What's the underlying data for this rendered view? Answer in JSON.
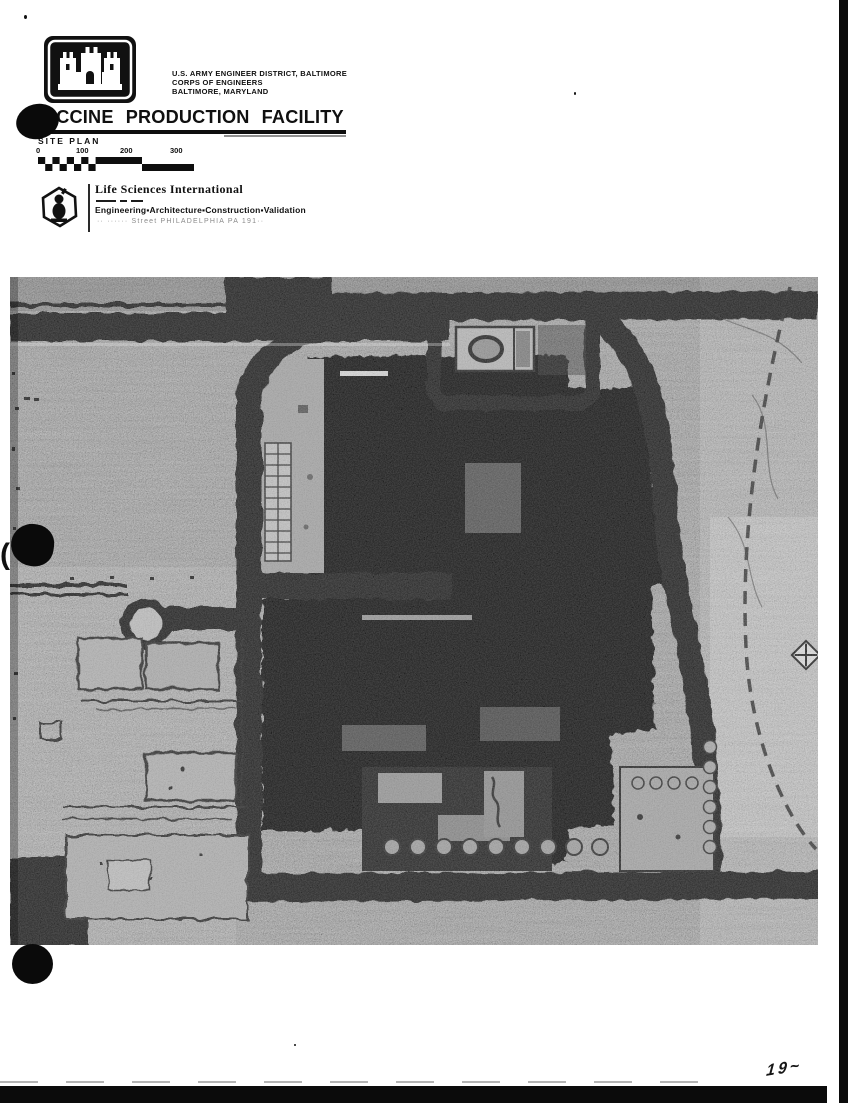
{
  "agency": {
    "line1": "U.S. ARMY ENGINEER DISTRICT, BALTIMORE",
    "line2": "CORPS OF ENGINEERS",
    "line3": "BALTIMORE, MARYLAND"
  },
  "titleblock": {
    "title": "VACCINE PRODUCTION FACILITY",
    "subtitle": "SITE PLAN"
  },
  "scale_bar": {
    "labels": [
      "0",
      "100",
      "200",
      "300"
    ]
  },
  "firm": {
    "name": "Life Sciences International",
    "tagline": "Engineering▪Architecture▪Construction▪Validation",
    "address_faint": "·· ······ Street   PHILADELPHIA   PA   191··"
  },
  "annotations": {
    "handwritten_page_mark": "19~",
    "left_margin_mark": "("
  },
  "icons": {
    "corps_logo": "army-corps-castle-icon",
    "firm_logo": "hexagon-emblem-icon"
  },
  "colors": {
    "ink": "#101010",
    "plan_base_gray": "#8f8f8f",
    "road_black": "#0c0c0c",
    "paper": "#ffffff"
  }
}
